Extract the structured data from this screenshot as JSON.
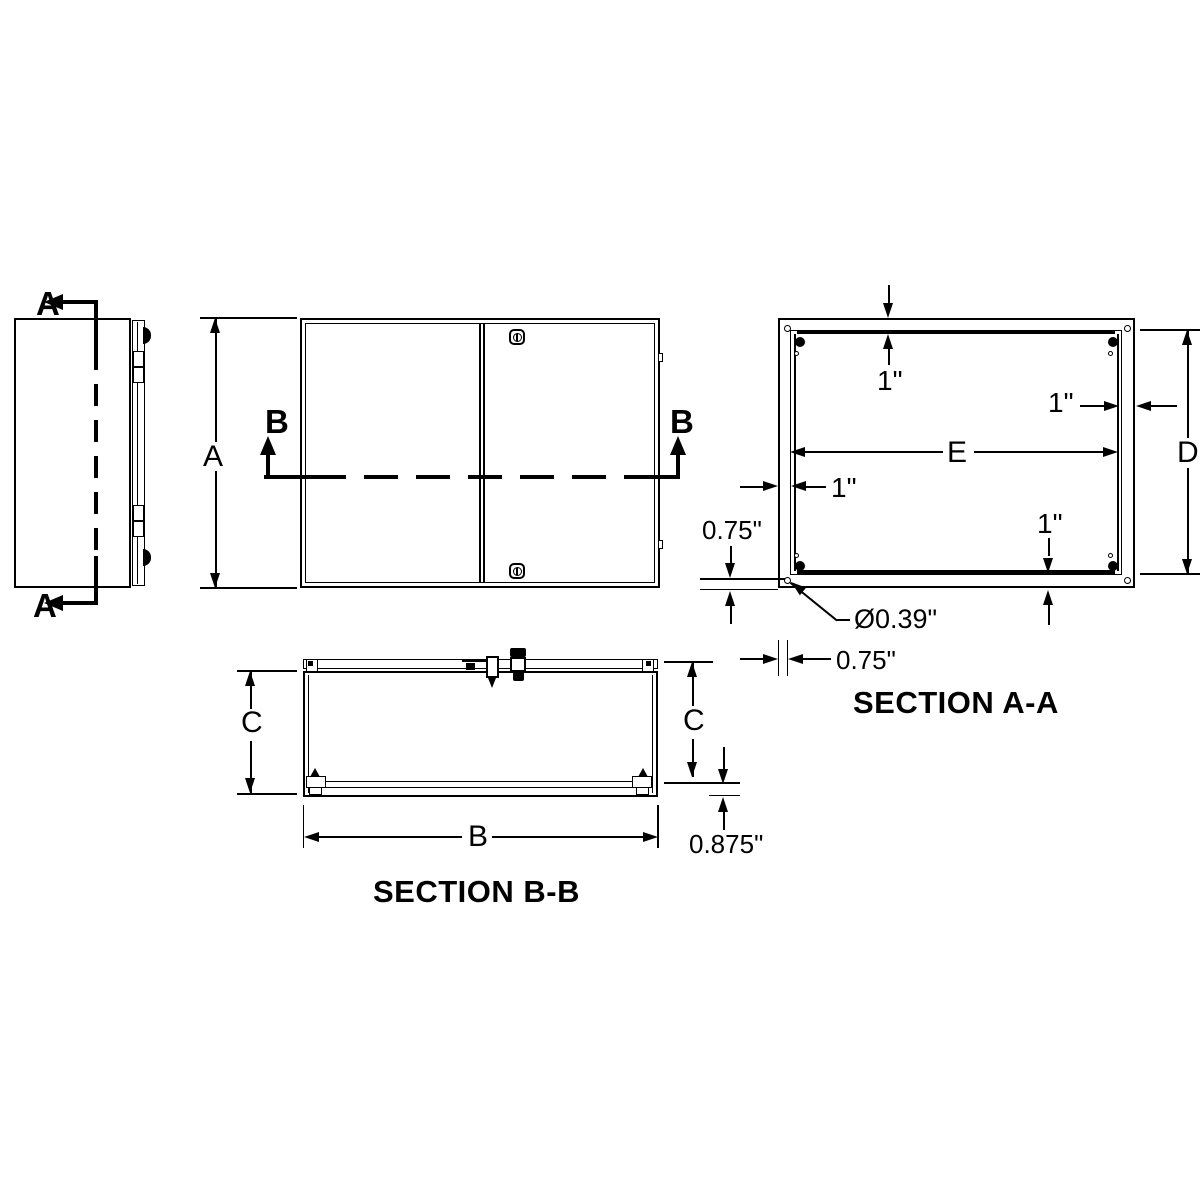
{
  "drawing": {
    "side_view": {
      "cut_top": "A",
      "cut_bottom": "A"
    },
    "front_view": {
      "height_dim": "A",
      "cut_left": "B",
      "cut_right": "B"
    },
    "section_aa": {
      "title": "SECTION A-A",
      "gap_top": "1\"",
      "gap_right": "1\"",
      "gap_left": "1\"",
      "gap_bottom": "1\"",
      "panel_width": "E",
      "panel_height": "D",
      "hole_offset_vertical": "0.75\"",
      "hole_offset_horizontal": "0.75\"",
      "hole_diameter": "Ø0.39\""
    },
    "section_bb": {
      "title": "SECTION B-B",
      "depth_left": "C",
      "depth_right": "C",
      "width": "B",
      "panel_standoff": "0.875\""
    }
  }
}
